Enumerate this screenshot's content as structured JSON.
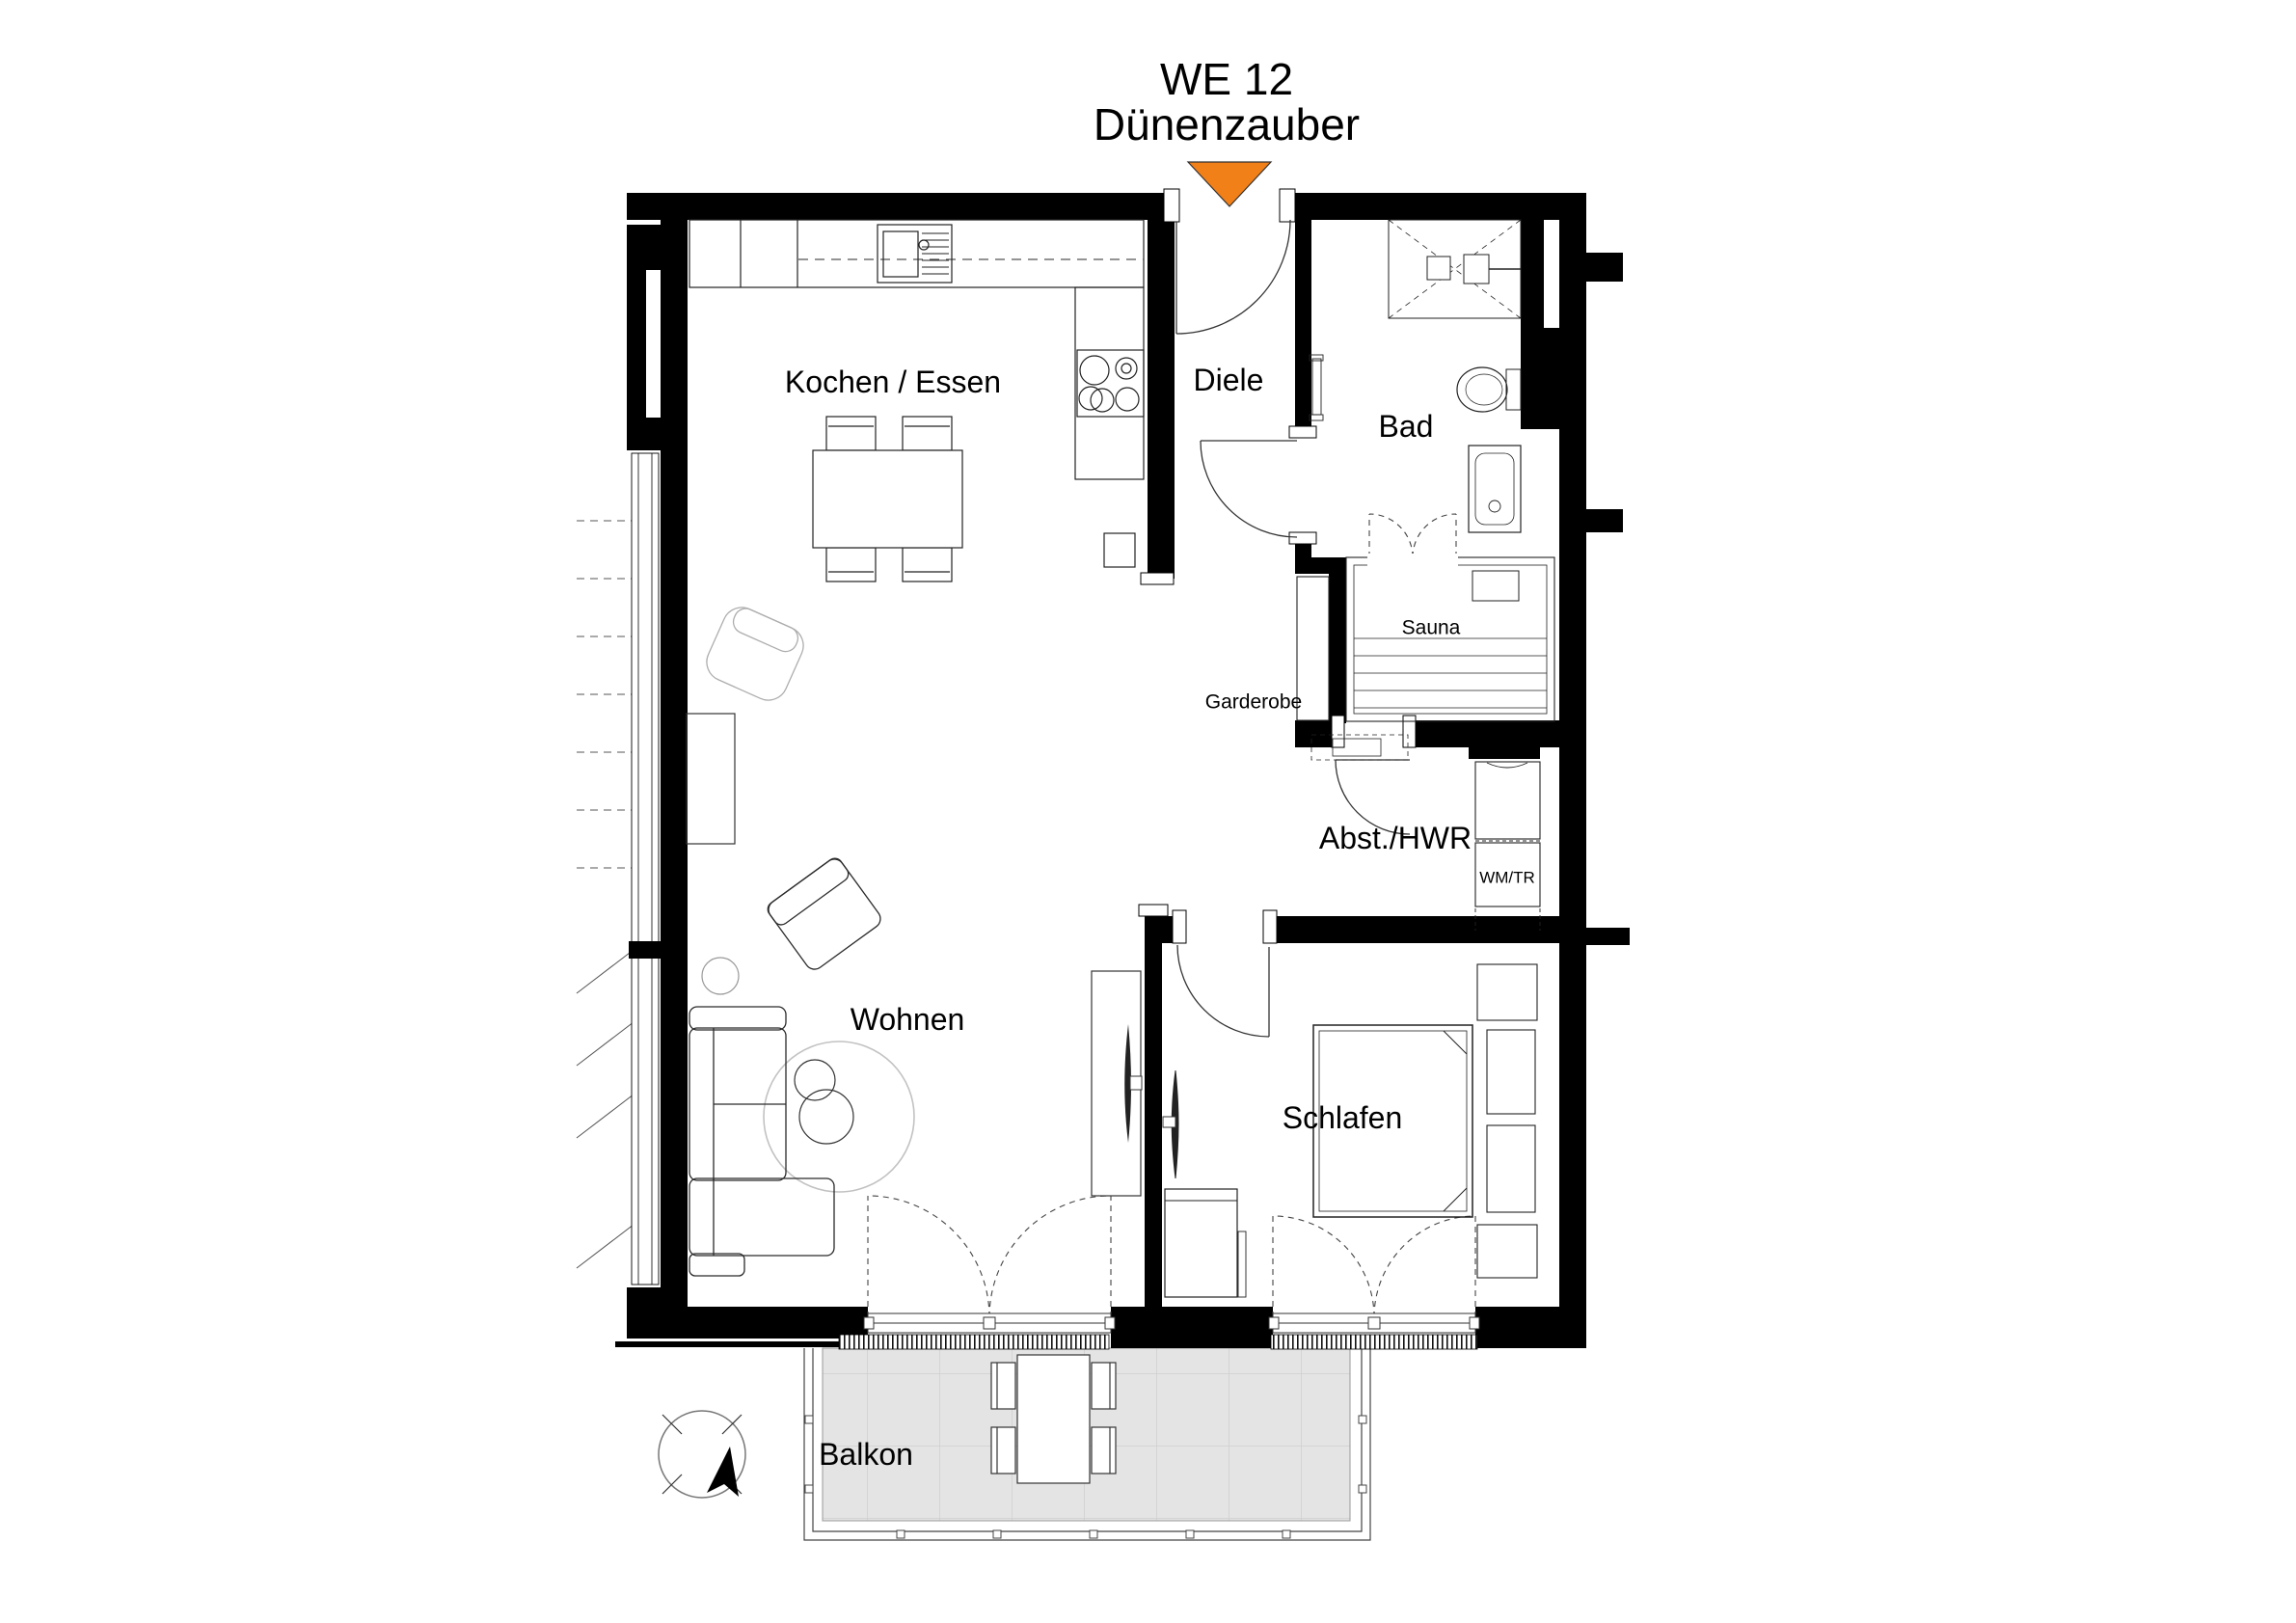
{
  "title": {
    "line1": "WE 12",
    "line2": "Dünenzauber"
  },
  "labels": {
    "kochen_essen": "Kochen / Essen",
    "diele": "Diele",
    "bad": "Bad",
    "sauna": "Sauna",
    "garderobe": "Garderobe",
    "abst_hwr": "Abst./HWR",
    "wm_tr": "WM/TR",
    "wohnen": "Wohnen",
    "schlafen": "Schlafen",
    "balkon": "Balkon"
  },
  "colors": {
    "wall": "#000000",
    "entrance_marker": "#F28019",
    "balcony_floor": "#E4E4E4",
    "balcony_grid": "#CFCFCF",
    "furniture_line": "#333333",
    "light_outline": "#ADADAD"
  }
}
